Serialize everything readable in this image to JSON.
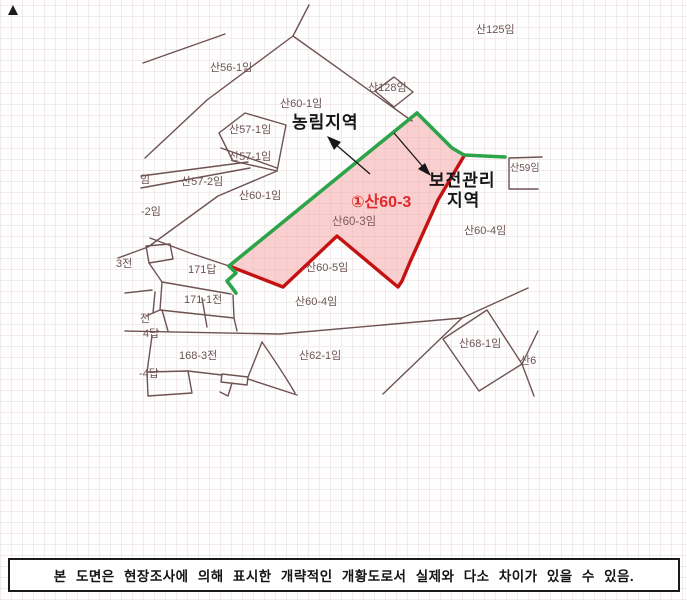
{
  "colors": {
    "parcel_line": "#6f5353",
    "label_text": "#6d5353",
    "green_boundary": "#2ea44a",
    "red_boundary": "#c41111",
    "pink_fill": "rgba(244,168,168,0.55)",
    "highlight_text": "#e12a2a",
    "annotation_text": "#161616",
    "note_border": "#1a1a1a"
  },
  "map": {
    "marker": "▲",
    "region_labels": {
      "nonglim": "농림지역",
      "bojeon_line1": "보전관리",
      "bojeon_line2": "지역"
    },
    "highlight": {
      "id": "①산60-3",
      "sub": "산60-3임"
    },
    "parcel_labels": [
      {
        "text": "산56-1임"
      },
      {
        "text": "산125임"
      },
      {
        "text": "산128임"
      },
      {
        "text": "산60-1임"
      },
      {
        "text": "산57-1임"
      },
      {
        "text": "산57-1임"
      },
      {
        "text": "임"
      },
      {
        "text": "산57-2임"
      },
      {
        "text": "산60-1임"
      },
      {
        "text": "-2임"
      },
      {
        "text": "산59임"
      },
      {
        "text": "산60-4임"
      },
      {
        "text": "171답"
      },
      {
        "text": "산60-5임"
      },
      {
        "text": "171-1전"
      },
      {
        "text": "3전"
      },
      {
        "text": "산60-4임"
      },
      {
        "text": "전"
      },
      {
        "text": "4답"
      },
      {
        "text": "168-3전"
      },
      {
        "text": "-4답"
      },
      {
        "text": "산62-1임"
      },
      {
        "text": "산68-1임"
      },
      {
        "text": "산6"
      }
    ]
  },
  "note": {
    "text": "본 도면은 현장조사에 의해 표시한 개략적인 개황도로서 실제와 다소 차이가 있을 수 있음."
  }
}
